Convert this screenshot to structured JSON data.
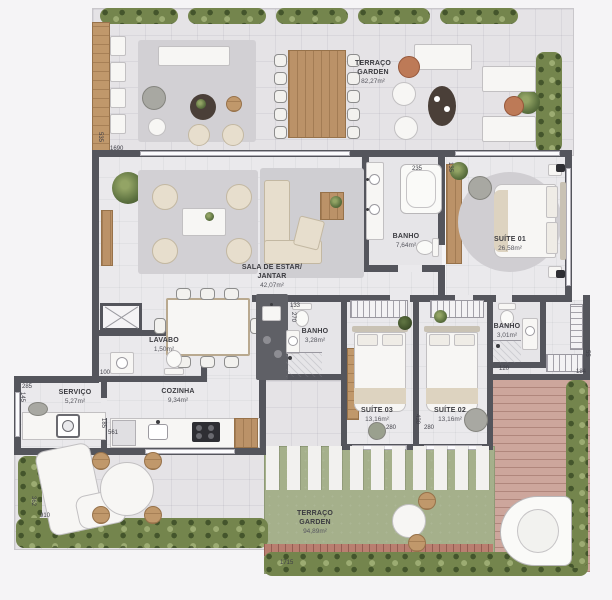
{
  "palette": {
    "wall": "#54555c",
    "indoor_floor": "#eae9ec",
    "terrace_floor": "#e5e3e6",
    "wood": "#c0986b",
    "hedge_green": "#74854d",
    "lawn_green": "#a5b08b",
    "deck_pink": "#cda69c",
    "label_text": "#3b3b40"
  },
  "rooms": {
    "terraco_top": {
      "name": "TERRAÇO",
      "name2": "GARDEN",
      "area": "82,27m²"
    },
    "sala": {
      "name": "SALA DE ESTAR/",
      "name2": "JANTAR",
      "area": "42,07m²"
    },
    "banho_suite01": {
      "name": "BANHO",
      "area": "7,64m²"
    },
    "suite01": {
      "name": "SUÍTE 01",
      "area": "26,58m²"
    },
    "lavabo": {
      "name": "LAVABO",
      "area": "1,50m²"
    },
    "banho_social": {
      "name": "BANHO",
      "area": "3,28m²"
    },
    "cozinha": {
      "name": "COZINHA",
      "area": "9,34m²"
    },
    "servico": {
      "name": "SERVIÇO",
      "area": "5,27m²"
    },
    "suite03": {
      "name": "SUÍTE 03",
      "area": "13,16m²"
    },
    "suite02": {
      "name": "SUÍTE 02",
      "area": "13,16m²"
    },
    "banho_suite02": {
      "name": "BANHO",
      "area": "3,01m²"
    },
    "terraco_bottom": {
      "name": "TERRAÇO",
      "name2": "GARDEN",
      "area": "94,89m²"
    }
  },
  "dimensions": {
    "top_width": "1690",
    "top_left_height": "535",
    "banho01_tub": "235",
    "banho01_side": "135",
    "hall_width": "133",
    "hall_depth": "270",
    "suite03_width": "280",
    "suites_depth": "430",
    "suite02_width": "280",
    "banho02_shower": "120",
    "hall_right_width": "55",
    "hall_right_len": "184",
    "cozinha_side": "185",
    "cozinha_counter": "561",
    "servico_width": "285",
    "servico_side": "145",
    "lavabo_width": "100",
    "terrace_left_depth": "362",
    "terrace_left_width": "910",
    "terrace_bottom_width": "1715"
  }
}
